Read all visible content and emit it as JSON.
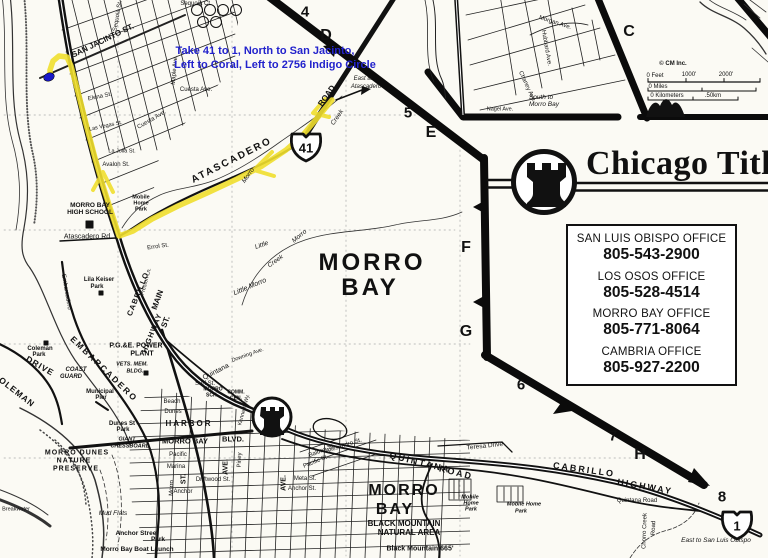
{
  "colors": {
    "ink": "#111111",
    "paper": "#fbfaf4",
    "route_highlight": "#f0df2e",
    "direction_text": "#2222cc",
    "destination_marker": "#1818c8"
  },
  "brand": {
    "name": "Chicago Title",
    "icon": "castle-rook-icon"
  },
  "directions": {
    "line1": "Take 41 to 1, North to San Jacinto,",
    "line2": "Left to Coral, Left to 2756 Indigo Circle"
  },
  "offices": [
    {
      "name": "SAN LUIS OBISPO OFFICE",
      "phone": "805-543-2900"
    },
    {
      "name": "LOS OSOS OFFICE",
      "phone": "805-528-4514"
    },
    {
      "name": "MORRO BAY OFFICE",
      "phone": "805-771-8064"
    },
    {
      "name": "CAMBRIA OFFICE",
      "phone": "805-927-2200"
    }
  ],
  "grid_index": {
    "numbers": [
      "4",
      "5",
      "6",
      "7",
      "8"
    ],
    "letters": [
      "C",
      "D",
      "E",
      "F",
      "G",
      "H"
    ]
  },
  "highway_shields": [
    {
      "route": "41"
    },
    {
      "route": "1"
    }
  ],
  "scale_bar": {
    "credit": "© CM Inc.",
    "feet": [
      "0 Feet",
      "1000'",
      "2000'"
    ],
    "miles": "0 Miles",
    "kilometers": "0 Kilometers",
    "km_end": ".50km"
  },
  "map": {
    "labels": [
      {
        "t": "4",
        "x": 305,
        "y": 12,
        "s": 15,
        "b": 1,
        "n": "grid-label-4"
      },
      {
        "t": "D",
        "x": 326,
        "y": 36,
        "s": 16,
        "b": 1,
        "n": "grid-label-d"
      },
      {
        "t": "5",
        "x": 408,
        "y": 113,
        "s": 15,
        "b": 1,
        "n": "grid-label-5"
      },
      {
        "t": "E",
        "x": 431,
        "y": 133,
        "s": 16,
        "b": 1,
        "n": "grid-label-e"
      },
      {
        "t": "C",
        "x": 629,
        "y": 32,
        "s": 16,
        "b": 1,
        "n": "grid-label-c"
      },
      {
        "t": "F",
        "x": 466,
        "y": 248,
        "s": 16,
        "b": 1,
        "n": "grid-label-f"
      },
      {
        "t": "G",
        "x": 466,
        "y": 332,
        "s": 16,
        "b": 1,
        "n": "grid-label-g"
      },
      {
        "t": "6",
        "x": 521,
        "y": 385,
        "s": 15,
        "b": 1,
        "n": "grid-label-6"
      },
      {
        "t": "7",
        "x": 613,
        "y": 436,
        "s": 15,
        "b": 1,
        "n": "grid-label-7"
      },
      {
        "t": "H",
        "x": 640,
        "y": 455,
        "s": 16,
        "b": 1,
        "n": "grid-label-h"
      },
      {
        "t": "8",
        "x": 722,
        "y": 497,
        "s": 15,
        "b": 1,
        "n": "grid-label-8"
      },
      {
        "t": "41",
        "x": 306,
        "y": 148,
        "s": 13,
        "b": 1,
        "n": "shield-41-number"
      },
      {
        "t": "1",
        "x": 737,
        "y": 526,
        "s": 13,
        "b": 1,
        "n": "shield-1-number"
      },
      {
        "t": "© CM Inc.",
        "x": 673,
        "y": 64,
        "s": 6,
        "b": 1,
        "n": "scale-credit"
      },
      {
        "t": "0 Feet",
        "x": 655,
        "y": 76,
        "s": 6
      },
      {
        "t": "1000'",
        "x": 689,
        "y": 75,
        "s": 6
      },
      {
        "t": "2000'",
        "x": 726,
        "y": 75,
        "s": 6
      },
      {
        "t": "0 Miles",
        "x": 658,
        "y": 87,
        "s": 6
      },
      {
        "t": "0 Kilometers",
        "x": 667,
        "y": 96,
        "s": 6
      },
      {
        "t": ".50km",
        "x": 713,
        "y": 96,
        "s": 6
      },
      {
        "t": "MORRO",
        "x": 372,
        "y": 263,
        "s": 24,
        "b": 1,
        "ls": 3,
        "n": "place-morro-bay"
      },
      {
        "t": "BAY",
        "x": 370,
        "y": 288,
        "s": 24,
        "b": 1,
        "ls": 3,
        "n": "place-morro-bay"
      },
      {
        "t": "MORRO",
        "x": 404,
        "y": 491,
        "s": 16,
        "b": 1,
        "ls": 2
      },
      {
        "t": "BAY",
        "x": 395,
        "y": 510,
        "s": 16,
        "b": 1,
        "ls": 2
      },
      {
        "t": "BLACK MOUNTAIN",
        "x": 404,
        "y": 524,
        "s": 8,
        "b": 1
      },
      {
        "t": "NATURAL AREA",
        "x": 409,
        "y": 533,
        "s": 8,
        "b": 1
      },
      {
        "t": "Black Mountain 665'",
        "x": 420,
        "y": 549,
        "s": 7,
        "b": 1
      },
      {
        "t": "SAN JACINTO ST.",
        "x": 103,
        "y": 41,
        "s": 8,
        "b": 1,
        "r": -26
      },
      {
        "t": "Sequoia St.",
        "x": 118,
        "y": 16,
        "s": 6,
        "r": -80
      },
      {
        "t": "Sequoia Ct.",
        "x": 196,
        "y": 4,
        "s": 6
      },
      {
        "t": "Elena St.",
        "x": 100,
        "y": 97,
        "s": 6,
        "r": -12
      },
      {
        "t": "Maple Ave.",
        "x": 175,
        "y": 70,
        "s": 6,
        "r": -85
      },
      {
        "t": "Cuesta Ave.",
        "x": 196,
        "y": 90,
        "s": 6
      },
      {
        "t": "Cuesta Ave.",
        "x": 152,
        "y": 120,
        "s": 6,
        "r": -30
      },
      {
        "t": "Las Vegas St.",
        "x": 106,
        "y": 127,
        "s": 5.5,
        "r": -12
      },
      {
        "t": "La Jolla St.",
        "x": 122,
        "y": 152,
        "s": 5.5
      },
      {
        "t": "Avalon St.",
        "x": 116,
        "y": 165,
        "s": 6
      },
      {
        "t": "ROAD",
        "x": 327,
        "y": 96,
        "s": 8,
        "b": 1,
        "r": -55
      },
      {
        "t": "ATASCADERO",
        "x": 232,
        "y": 161,
        "s": 10,
        "b": 1,
        "r": -27,
        "ls": 2
      },
      {
        "t": "East to",
        "x": 363,
        "y": 79,
        "s": 6,
        "i": 1
      },
      {
        "t": "Atascadero",
        "x": 366,
        "y": 87,
        "s": 6,
        "i": 1
      },
      {
        "t": "Morro",
        "x": 249,
        "y": 176,
        "s": 6.5,
        "i": 1,
        "r": -55
      },
      {
        "t": "Creek",
        "x": 338,
        "y": 118,
        "s": 6.5,
        "i": 1,
        "r": -55
      },
      {
        "t": "Atascadero Rd.",
        "x": 88,
        "y": 237,
        "s": 7
      },
      {
        "t": "MORRO BAY",
        "x": 90,
        "y": 206,
        "s": 6.5,
        "b": 1
      },
      {
        "t": "HIGH SCHOOL",
        "x": 90,
        "y": 213,
        "s": 6.5,
        "b": 1
      },
      {
        "t": "Mobile",
        "x": 141,
        "y": 198,
        "s": 5.5,
        "b": 1
      },
      {
        "t": "Home",
        "x": 141,
        "y": 204,
        "s": 5.5,
        "b": 1
      },
      {
        "t": "Park",
        "x": 141,
        "y": 210,
        "s": 5.5,
        "b": 1
      },
      {
        "t": "Errol St.",
        "x": 158,
        "y": 247,
        "s": 6,
        "r": -8
      },
      {
        "t": "Little",
        "x": 262,
        "y": 246,
        "s": 6.5,
        "i": 1,
        "r": -20
      },
      {
        "t": "Morro",
        "x": 300,
        "y": 237,
        "s": 6.5,
        "i": 1,
        "r": -40
      },
      {
        "t": "Creek",
        "x": 276,
        "y": 262,
        "s": 6.5,
        "i": 1,
        "r": -35
      },
      {
        "t": "Little Morro",
        "x": 250,
        "y": 287,
        "s": 7,
        "i": 1,
        "r": -23
      },
      {
        "t": "MAIN",
        "x": 158,
        "y": 300,
        "s": 8,
        "b": 1,
        "r": -70
      },
      {
        "t": "ST.",
        "x": 166,
        "y": 322,
        "s": 8,
        "b": 1,
        "r": -70
      },
      {
        "t": "CABRILLO",
        "x": 138,
        "y": 294,
        "s": 7.5,
        "b": 1,
        "r": -68,
        "ls": 1
      },
      {
        "t": "HIGHWAY",
        "x": 152,
        "y": 333,
        "s": 7.5,
        "b": 1,
        "r": -68,
        "ls": 1
      },
      {
        "t": "Preston Ln.",
        "x": 147,
        "y": 282,
        "s": 5.5,
        "r": -75
      },
      {
        "t": "P.G.&E. POWER",
        "x": 136,
        "y": 346,
        "s": 7,
        "b": 1
      },
      {
        "t": "PLANT",
        "x": 142,
        "y": 354,
        "s": 7,
        "b": 1
      },
      {
        "t": "VETS. MEM.",
        "x": 132,
        "y": 365,
        "s": 5.5,
        "b": 1,
        "i": 1
      },
      {
        "t": "BLDG.",
        "x": 135,
        "y": 372,
        "s": 5.5,
        "b": 1,
        "i": 1
      },
      {
        "t": "EMBARCADERO",
        "x": 104,
        "y": 369,
        "s": 8.5,
        "b": 1,
        "r": 44,
        "ls": 2
      },
      {
        "t": "Embarcadero",
        "x": 66,
        "y": 292,
        "s": 6,
        "r": 80
      },
      {
        "t": "COLEMAN",
        "x": 14,
        "y": 390,
        "s": 8.5,
        "b": 1,
        "r": 38,
        "ls": 1
      },
      {
        "t": "DRIVE",
        "x": 40,
        "y": 366,
        "s": 8.5,
        "b": 1,
        "r": 30,
        "ls": 1
      },
      {
        "t": "Coleman",
        "x": 40,
        "y": 349,
        "s": 6,
        "b": 1
      },
      {
        "t": "Park",
        "x": 39,
        "y": 355,
        "s": 6,
        "b": 1
      },
      {
        "t": "Lila Keiser",
        "x": 99,
        "y": 280,
        "s": 6,
        "b": 1
      },
      {
        "t": "Park",
        "x": 97,
        "y": 287,
        "s": 6,
        "b": 1
      },
      {
        "t": "COAST",
        "x": 76,
        "y": 370,
        "s": 6,
        "b": 1,
        "i": 1
      },
      {
        "t": "GUARD",
        "x": 71,
        "y": 377,
        "s": 6,
        "b": 1,
        "i": 1
      },
      {
        "t": "Municipal",
        "x": 100,
        "y": 392,
        "s": 6,
        "b": 1
      },
      {
        "t": "Pier",
        "x": 101,
        "y": 398,
        "s": 6,
        "b": 1
      },
      {
        "t": "MORRO DUNES",
        "x": 77,
        "y": 453,
        "s": 7,
        "b": 1,
        "ls": 1
      },
      {
        "t": "NATURE",
        "x": 74,
        "y": 461,
        "s": 7,
        "b": 1,
        "ls": 1
      },
      {
        "t": "PRESERVE",
        "x": 76,
        "y": 469,
        "s": 7,
        "b": 1,
        "ls": 1
      },
      {
        "t": "Dunes St",
        "x": 122,
        "y": 424,
        "s": 6,
        "b": 1
      },
      {
        "t": "Park",
        "x": 123,
        "y": 430,
        "s": 6,
        "b": 1
      },
      {
        "t": "GIANT",
        "x": 127,
        "y": 440,
        "s": 5.5,
        "b": 1,
        "i": 1
      },
      {
        "t": "CHESSBOARD",
        "x": 130,
        "y": 447,
        "s": 5.5,
        "b": 1,
        "i": 1
      },
      {
        "t": "Mud Flats",
        "x": 113,
        "y": 514,
        "s": 6.5,
        "i": 1
      },
      {
        "t": "Anchor Street",
        "x": 137,
        "y": 534,
        "s": 6.5,
        "b": 1
      },
      {
        "t": "Park",
        "x": 158,
        "y": 540,
        "s": 6.5,
        "b": 1
      },
      {
        "t": "Morro Bay Boat Launch",
        "x": 137,
        "y": 550,
        "s": 6.5,
        "b": 1
      },
      {
        "t": "Breakwater",
        "x": 16,
        "y": 510,
        "s": 5.5
      },
      {
        "t": "HARBOR",
        "x": 189,
        "y": 424,
        "s": 8,
        "b": 1,
        "ls": 2
      },
      {
        "t": "MORRO BAY",
        "x": 185,
        "y": 441,
        "s": 7.5,
        "b": 1
      },
      {
        "t": "BLVD.",
        "x": 233,
        "y": 439,
        "s": 7.5,
        "b": 1
      },
      {
        "t": "Pacific",
        "x": 178,
        "y": 455,
        "s": 6
      },
      {
        "t": "Marina",
        "x": 176,
        "y": 467,
        "s": 6
      },
      {
        "t": "Driftwood St.",
        "x": 213,
        "y": 480,
        "s": 6
      },
      {
        "t": "Anchor",
        "x": 183,
        "y": 492,
        "s": 6
      },
      {
        "t": "Beach",
        "x": 172,
        "y": 402,
        "s": 6
      },
      {
        "t": "Dunes",
        "x": 173,
        "y": 412,
        "s": 6
      },
      {
        "t": "Surf St.",
        "x": 205,
        "y": 384,
        "s": 6
      },
      {
        "t": "MORRO",
        "x": 213,
        "y": 390,
        "s": 5,
        "b": 1
      },
      {
        "t": "SCH.",
        "x": 212,
        "y": 396,
        "s": 5,
        "b": 1
      },
      {
        "t": "COMM.",
        "x": 236,
        "y": 393,
        "s": 5,
        "b": 1
      },
      {
        "t": "CEN.",
        "x": 236,
        "y": 399,
        "s": 5,
        "b": 1
      },
      {
        "t": "ST.",
        "x": 184,
        "y": 479,
        "s": 7,
        "b": 1,
        "r": -90
      },
      {
        "t": "Piney",
        "x": 240,
        "y": 460,
        "s": 6,
        "r": -88
      },
      {
        "t": "Morro",
        "x": 172,
        "y": 488,
        "s": 6,
        "r": -88
      },
      {
        "t": "AVE.",
        "x": 226,
        "y": 467,
        "s": 7,
        "b": 1,
        "r": -90
      },
      {
        "t": "AVE.",
        "x": 284,
        "y": 483,
        "s": 7,
        "b": 1,
        "r": -90
      },
      {
        "t": "Kennedy Wy.",
        "x": 245,
        "y": 410,
        "s": 5.5,
        "r": -75
      },
      {
        "t": "Quintana",
        "x": 216,
        "y": 372,
        "s": 7,
        "r": -27
      },
      {
        "t": "Balboa St.",
        "x": 322,
        "y": 451,
        "s": 6,
        "r": -22
      },
      {
        "t": "Pacific St.",
        "x": 316,
        "y": 462,
        "s": 6,
        "r": -22
      },
      {
        "t": "Allesandro St.",
        "x": 344,
        "y": 446,
        "s": 6,
        "r": -18
      },
      {
        "t": "Meta St.",
        "x": 305,
        "y": 479,
        "s": 6
      },
      {
        "t": "Anchor St.",
        "x": 302,
        "y": 489,
        "s": 6
      },
      {
        "t": "Downing Ave.",
        "x": 248,
        "y": 356,
        "s": 5.5,
        "r": -20
      },
      {
        "t": "QUINTANA",
        "x": 420,
        "y": 463,
        "s": 9,
        "b": 1,
        "r": 14,
        "ls": 2
      },
      {
        "t": "ROAD",
        "x": 456,
        "y": 473,
        "s": 9,
        "b": 1,
        "r": 14,
        "ls": 2
      },
      {
        "t": "CABRILLO",
        "x": 584,
        "y": 470,
        "s": 9,
        "b": 1,
        "r": 8,
        "ls": 2
      },
      {
        "t": "HIGHWAY",
        "x": 645,
        "y": 487,
        "s": 9,
        "b": 1,
        "r": 10,
        "ls": 2
      },
      {
        "t": "Teresa Drive",
        "x": 485,
        "y": 447,
        "s": 6.5,
        "r": -6
      },
      {
        "t": "Mobile",
        "x": 470,
        "y": 498,
        "s": 5.5,
        "b": 1,
        "i": 1
      },
      {
        "t": "Home",
        "x": 471,
        "y": 504,
        "s": 5.5,
        "b": 1,
        "i": 1
      },
      {
        "t": "Park",
        "x": 471,
        "y": 510,
        "s": 5.5,
        "b": 1,
        "i": 1
      },
      {
        "t": "Mobile Home",
        "x": 524,
        "y": 505,
        "s": 5.5,
        "b": 1,
        "i": 1
      },
      {
        "t": "Park",
        "x": 521,
        "y": 512,
        "s": 5.5,
        "b": 1,
        "i": 1
      },
      {
        "t": "Quintana Road",
        "x": 637,
        "y": 501,
        "s": 6
      },
      {
        "t": "Chorro Creek",
        "x": 645,
        "y": 531,
        "s": 6,
        "r": -88
      },
      {
        "t": "Road",
        "x": 654,
        "y": 528,
        "s": 6,
        "r": -88
      },
      {
        "t": "East to San Luis Obispo",
        "x": 716,
        "y": 541,
        "s": 6.5,
        "i": 1
      },
      {
        "t": "South to",
        "x": 541,
        "y": 98,
        "s": 6.5,
        "i": 1
      },
      {
        "t": "Morro Bay",
        "x": 544,
        "y": 105,
        "s": 6.5,
        "i": 1
      },
      {
        "t": "Morgan Ave.",
        "x": 555,
        "y": 23,
        "s": 6,
        "r": 18
      },
      {
        "t": "Hubbard Ave.",
        "x": 546,
        "y": 48,
        "s": 6,
        "r": 80
      },
      {
        "t": "Chaney Ave.",
        "x": 527,
        "y": 87,
        "s": 6,
        "r": 65
      },
      {
        "t": "Nagel Ave.",
        "x": 500,
        "y": 110,
        "s": 5.5
      }
    ]
  }
}
